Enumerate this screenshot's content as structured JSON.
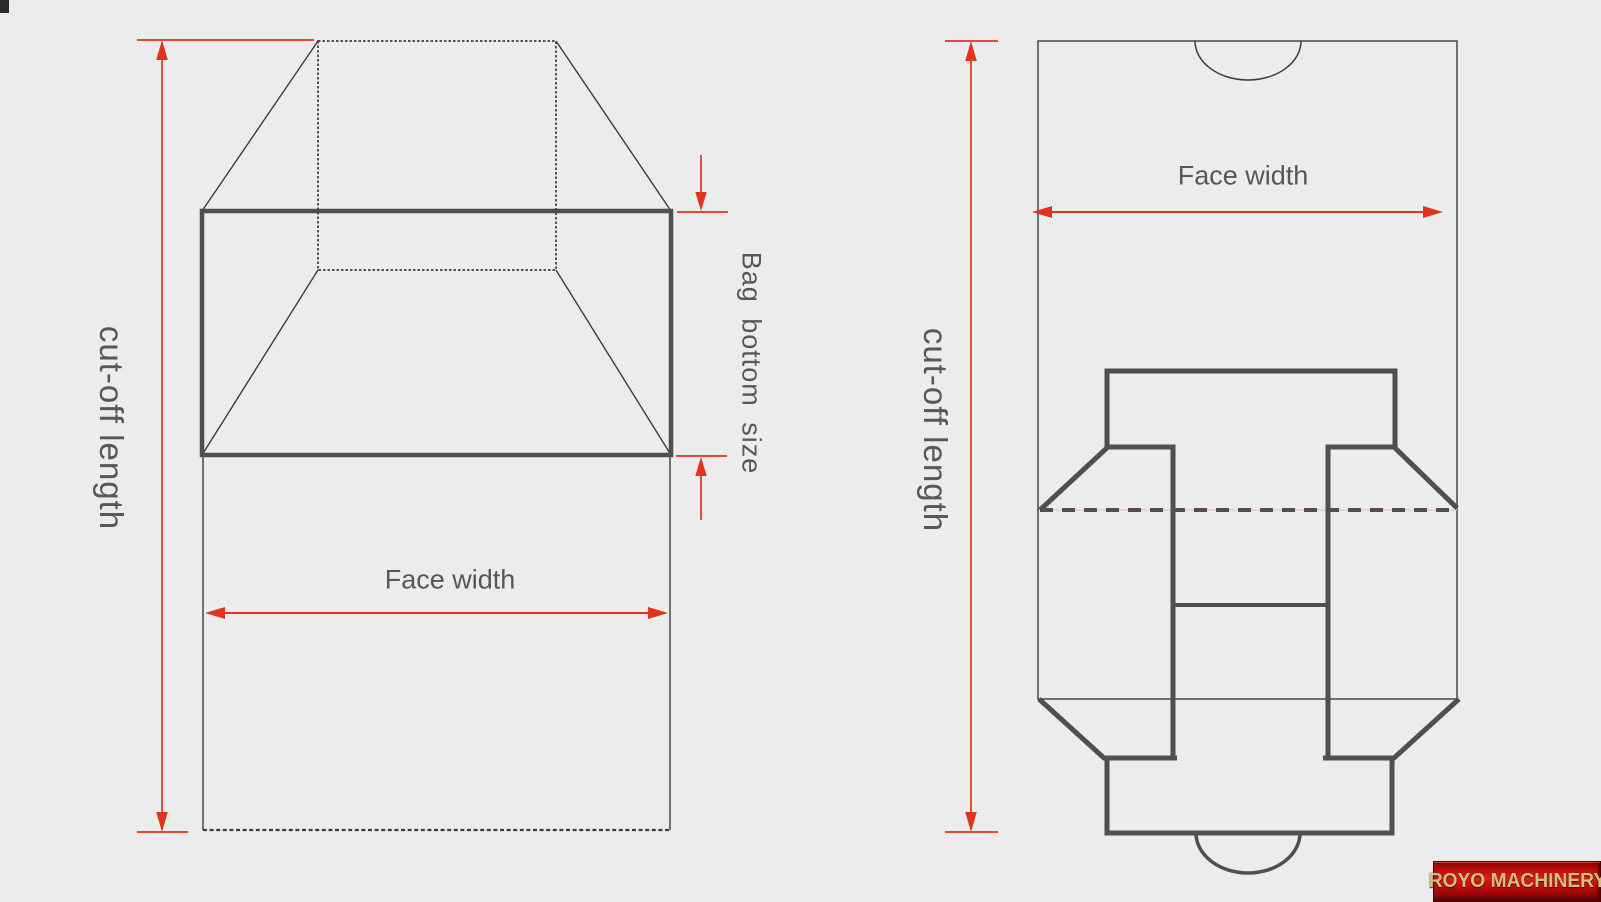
{
  "page": {
    "background_color": "#ececec"
  },
  "colors": {
    "dimension_red": "#e2331c",
    "thin_line": "#3c3c3c",
    "thick_line": "#4f4f4f",
    "label_text": "#575757",
    "logo_background_red": "#c40505",
    "logo_text_gold": "#d8bd80"
  },
  "left_diagram": {
    "cut_off_length_label": "cut-off length",
    "face_width_label": "Face width",
    "bag_bottom_size_label": "Bag bottom size"
  },
  "right_diagram": {
    "cut_off_length_label": "cut-off length",
    "face_width_label": "Face width"
  },
  "logo": {
    "text": "ROYO MACHINERY"
  }
}
